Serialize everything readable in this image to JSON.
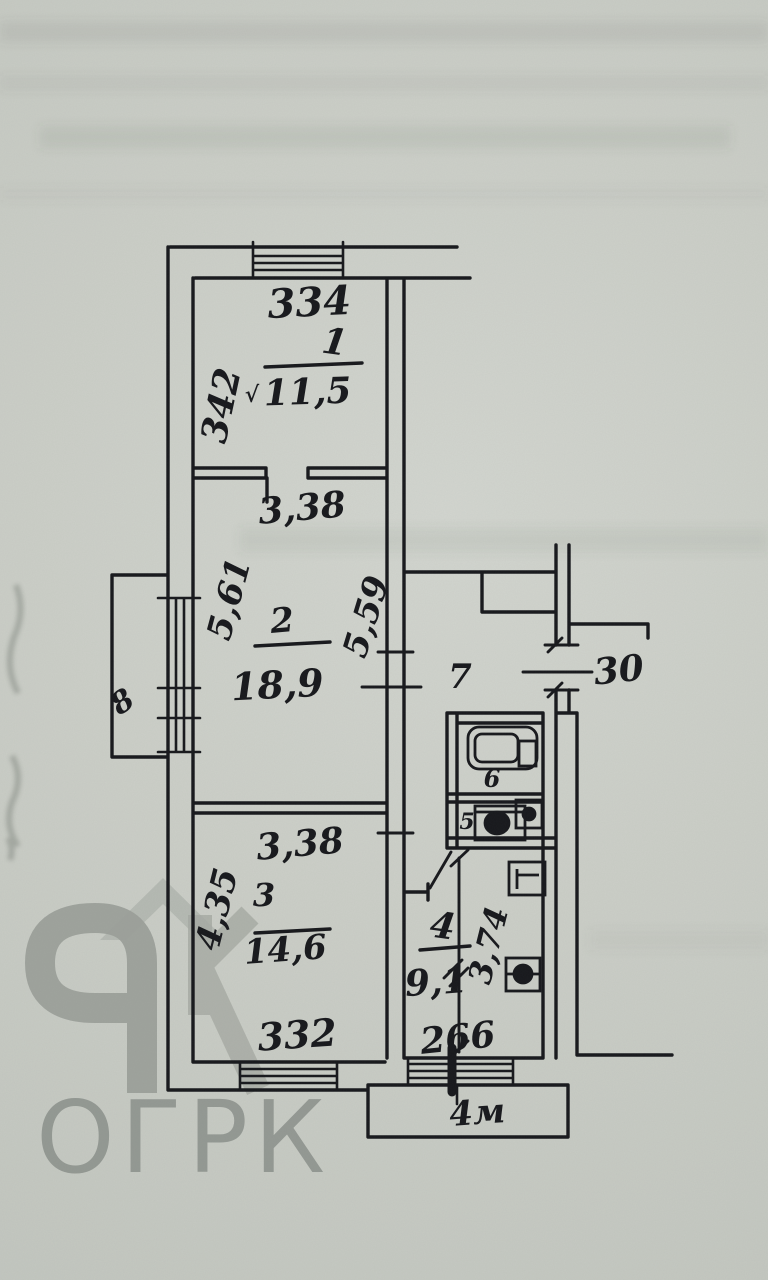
{
  "page": {
    "kind": "hand-drawn apartment floor plan",
    "paper_color": "#cccfc8",
    "ink_color": "#17181c",
    "watermark_color": "#8b908b"
  },
  "watermark": {
    "text": "ОГРК"
  },
  "plan": {
    "rooms": [
      {
        "key": "room-1",
        "number": "1",
        "area": "11,5",
        "check": "√",
        "dim_top": "334",
        "dim_side": "342"
      },
      {
        "key": "room-2",
        "number": "2",
        "area": "18,9",
        "dim_top": "3,38",
        "dim_left": "5,61",
        "dim_right": "5,59"
      },
      {
        "key": "room-3",
        "number": "3",
        "area": "14,6",
        "dim_top": "3,38",
        "dim_left": "4,35",
        "dim_bottom": "332"
      },
      {
        "key": "kitchen-4",
        "number": "4",
        "area": "9,1",
        "dim_side": "3,74",
        "dim_bottom": "266"
      },
      {
        "key": "wc-5",
        "number": "5"
      },
      {
        "key": "bathroom-6",
        "number": "6"
      },
      {
        "key": "hallway-7",
        "number": "7"
      },
      {
        "key": "balcony-8",
        "number": "8"
      },
      {
        "key": "balcony-bottom",
        "label": "4м"
      }
    ],
    "entry_label": "30"
  }
}
